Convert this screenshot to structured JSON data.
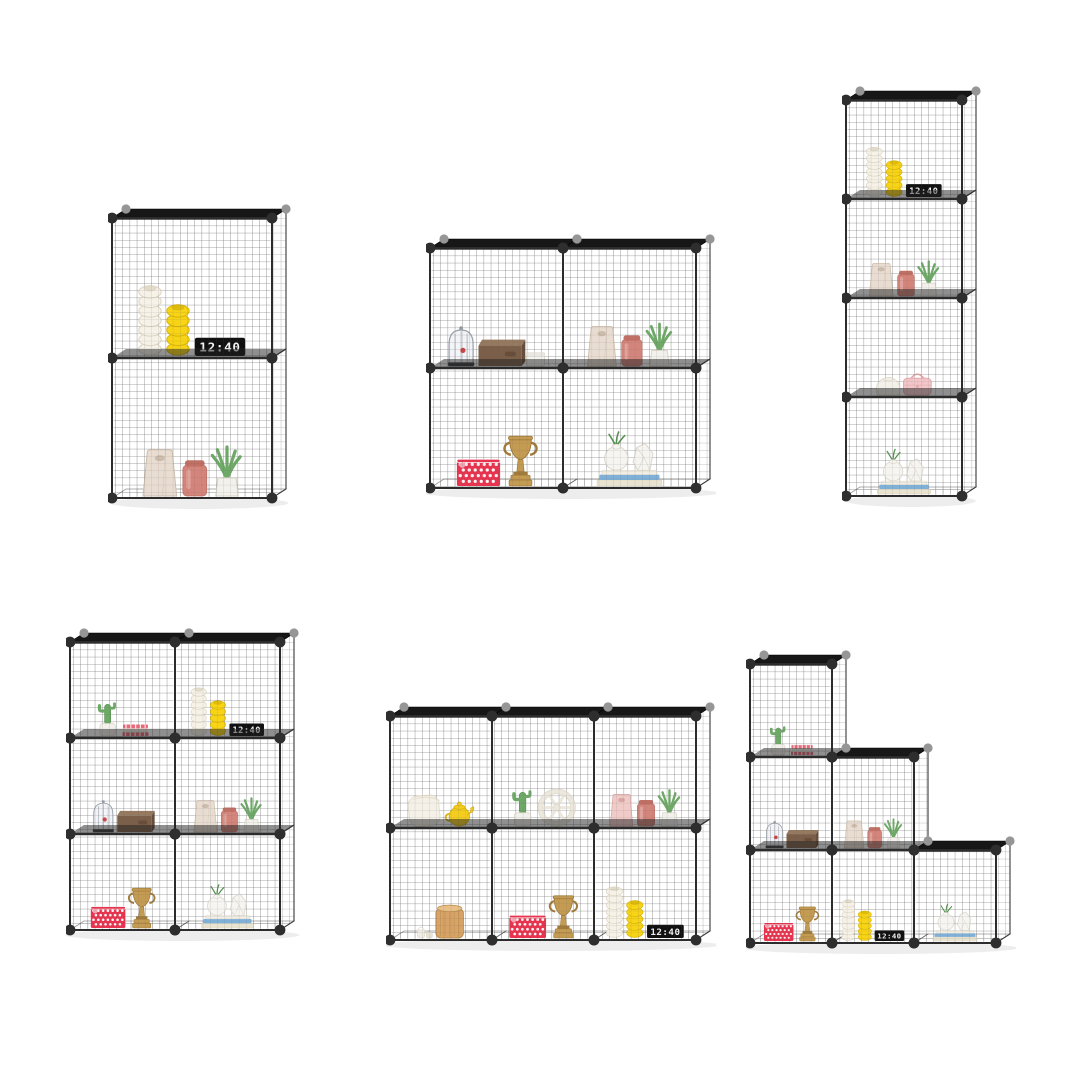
{
  "page": {
    "background": "#ffffff",
    "content_type": "product photo collage of modular wire cube storage shelves"
  },
  "product": {
    "name": "wire-grid-cube-storage-shelf",
    "clock_time": "12:40",
    "colors": {
      "background": "#ffffff",
      "wire": "#5a5a5a",
      "frame": "#2c2c2c",
      "shelf_panel": "#171717",
      "divider_panel": "#202020",
      "connector_front": "#2e2e2e",
      "connector_back": "#969696",
      "candle_white": "#f6f2e8",
      "candle_white_line": "#ddd5c3",
      "candle_yellow": "#f8d416",
      "candle_yellow_line": "#d8b409",
      "clock_body": "#101010",
      "clock_digits": "#f2f2f2",
      "bag_cream": "#e9ddd2",
      "bag_cream_shade": "#ccbcab",
      "bag_pink": "#f0cbc8",
      "bag_pink_shade": "#d8a7a4",
      "canister_pink": "#d4857b",
      "canister_pink_dark": "#c07065",
      "plant_green": "#6fa968",
      "plant_green_dark": "#55904f",
      "pot_white": "#f3f1ec",
      "pot_stroke": "#d9d4c8",
      "cage_glass": "#eef0f4",
      "cage_stroke": "#9aa0a8",
      "cage_base": "#3a3a3a",
      "bird_red": "#c94747",
      "box_brown": "#7c5f49",
      "box_brown_top": "#967a5f",
      "box_brown_side": "#684d3a",
      "box_white": "#f5f4f1",
      "basket_red": "#e8344f",
      "basket_dot": "#ffffff",
      "trophy_gold": "#c49b52",
      "trophy_gold_dark": "#a07b3b",
      "book_blue": "#7fb0d8",
      "book_cream": "#e9e4d1",
      "book_white": "#f3efe6",
      "vase_white": "#f7f5f1",
      "vase_stroke": "#ddd9cf",
      "stripe_red": "#e8697a",
      "pillow_white": "#f5f1e8",
      "pillow_line": "#e4dccb",
      "teapot_yellow": "#f4cd1f",
      "teapot_dark": "#d7b112",
      "wheel_white": "#ece8dd",
      "wheel_outline": "#d9d4c5",
      "barrel_tan": "#d8a367",
      "barrel_line": "#bd8c4e",
      "barrel_top": "#e9c188",
      "handbag_pink": "#f3c7ca",
      "handbag_dark": "#e0a6aa",
      "pouch_white": "#f4f1ea",
      "pouch_line": "#ded8c9",
      "jar_white": "#efece4",
      "shadow": "rgba(0,0,0,0.07)"
    }
  },
  "units": [
    {
      "id": "shelf-unit-2-stack",
      "description": "2 cubes stacked vertically",
      "cells": [
        {
          "items": [
            "white-spiral-candle",
            "yellow-spiral-candle",
            "digital-clock"
          ]
        },
        {
          "items": [
            "cream-gift-bag",
            "pink-canister",
            "potted-aloe"
          ]
        }
      ]
    },
    {
      "id": "shelf-unit-2x2",
      "description": "2 x 2 cube grid",
      "cells": [
        {
          "items": [
            "birdcage",
            "brown-storage-box",
            "white-box"
          ]
        },
        {
          "items": [
            "cream-gift-bag",
            "pink-canister",
            "potted-aloe"
          ]
        },
        {
          "items": [
            "red-polka-basket",
            "gold-trophy"
          ]
        },
        {
          "items": [
            "vases-on-books"
          ]
        }
      ]
    },
    {
      "id": "shelf-unit-4-tower",
      "description": "1 x 4 cube tower",
      "cells": [
        {
          "items": [
            "white-spiral-candle",
            "yellow-spiral-candle",
            "digital-clock"
          ]
        },
        {
          "items": [
            "cream-gift-bag",
            "pink-canister",
            "potted-aloe"
          ]
        },
        {
          "items": [
            "white-pouch",
            "pink-handbag"
          ]
        },
        {
          "items": [
            "vases-on-books"
          ]
        }
      ]
    },
    {
      "id": "shelf-unit-2x3",
      "description": "2 x 3 cube grid",
      "cells": [
        {
          "items": [
            "potted-cactus",
            "striped-books"
          ]
        },
        {
          "items": [
            "white-spiral-candle",
            "yellow-spiral-candle",
            "digital-clock"
          ]
        },
        {
          "items": [
            "birdcage",
            "brown-storage-box"
          ]
        },
        {
          "items": [
            "cream-gift-bag",
            "pink-canister",
            "potted-aloe"
          ]
        },
        {
          "items": [
            "red-polka-basket",
            "gold-trophy"
          ]
        },
        {
          "items": [
            "vases-on-books"
          ]
        }
      ]
    },
    {
      "id": "shelf-unit-3x2",
      "description": "3 x 2 cube grid",
      "cells": [
        {
          "items": [
            "white-pillow",
            "yellow-teapot"
          ]
        },
        {
          "items": [
            "potted-cactus",
            "white-wheel-decor"
          ]
        },
        {
          "items": [
            "pink-gift-bag",
            "pink-canister",
            "potted-aloe"
          ]
        },
        {
          "items": [
            "small-white-jars",
            "wooden-barrel"
          ]
        },
        {
          "items": [
            "red-polka-basket",
            "gold-trophy"
          ]
        },
        {
          "items": [
            "white-spiral-candle",
            "yellow-spiral-candle",
            "digital-clock"
          ]
        }
      ]
    },
    {
      "id": "shelf-unit-staircase",
      "description": "3-step staircase of cubes",
      "cells": [
        {
          "items": [
            "potted-cactus",
            "striped-books"
          ]
        },
        {
          "items": [
            "birdcage",
            "brown-storage-box"
          ]
        },
        {
          "items": [
            "cream-gift-bag",
            "pink-canister",
            "potted-aloe"
          ]
        },
        {
          "items": [
            "red-polka-basket",
            "gold-trophy"
          ]
        },
        {
          "items": [
            "white-spiral-candle",
            "yellow-spiral-candle",
            "digital-clock"
          ]
        },
        {
          "items": [
            "vases-on-books"
          ]
        }
      ]
    }
  ]
}
